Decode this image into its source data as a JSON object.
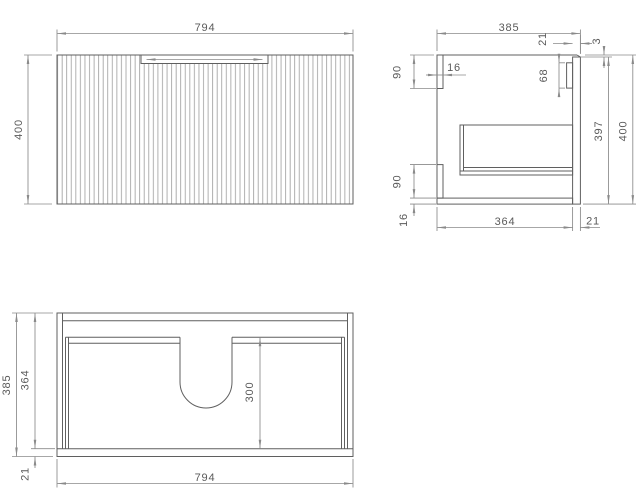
{
  "drawing": {
    "type": "vanity-cabinet-technical-drawing",
    "views": {
      "front": {
        "width": "794",
        "height": "400"
      },
      "side": {
        "depth": "385",
        "top_rail_height": "90",
        "rail_thickness": "16",
        "front_thickness_top": "21",
        "top_gap": "3",
        "hanging_rail_height": "68",
        "front_panel_height": "397",
        "overall_height": "400",
        "bottom_rail_height": "90",
        "bottom_panel_thickness": "16",
        "internal_depth": "364",
        "front_thickness_bottom": "21"
      },
      "plan": {
        "overall_depth": "385",
        "internal_depth": "364",
        "front_thickness": "21",
        "cutout_depth": "300",
        "width": "794"
      }
    },
    "colors": {
      "object_line": "#5f5f5f",
      "dimension_line": "#8a8a8a",
      "text": "#5a5a5a",
      "flute_line": "#9c9c9c",
      "background": "#ffffff"
    }
  }
}
